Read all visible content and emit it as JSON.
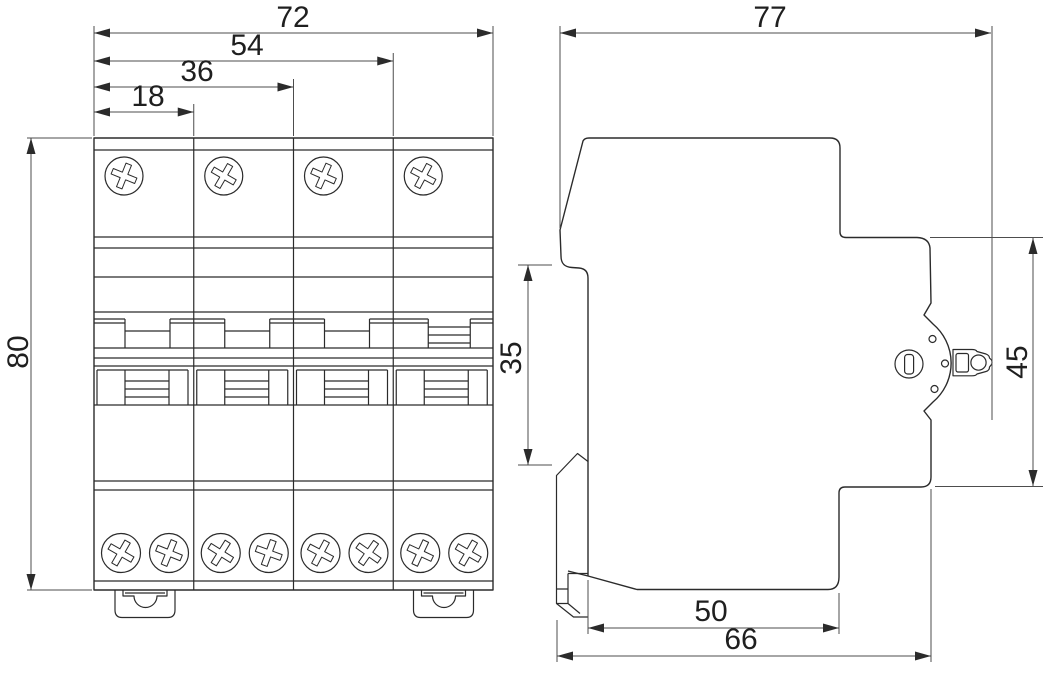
{
  "drawing": {
    "kind": "technical-dimension-drawing",
    "subject": "4-pole DIN-rail circuit breaker, front and side views"
  },
  "colors": {
    "line": "#2b2b2b",
    "dim": "#4d4d4d",
    "background": "#ffffff"
  },
  "dimensions": {
    "front": {
      "total_width": "72",
      "width_three_modules": "54",
      "width_two_modules": "36",
      "width_one_module": "18",
      "height": "80"
    },
    "side": {
      "total_depth": "77",
      "front_height": "45",
      "din_rail_height": "35",
      "base_depth": "50",
      "body_depth": "66"
    }
  }
}
